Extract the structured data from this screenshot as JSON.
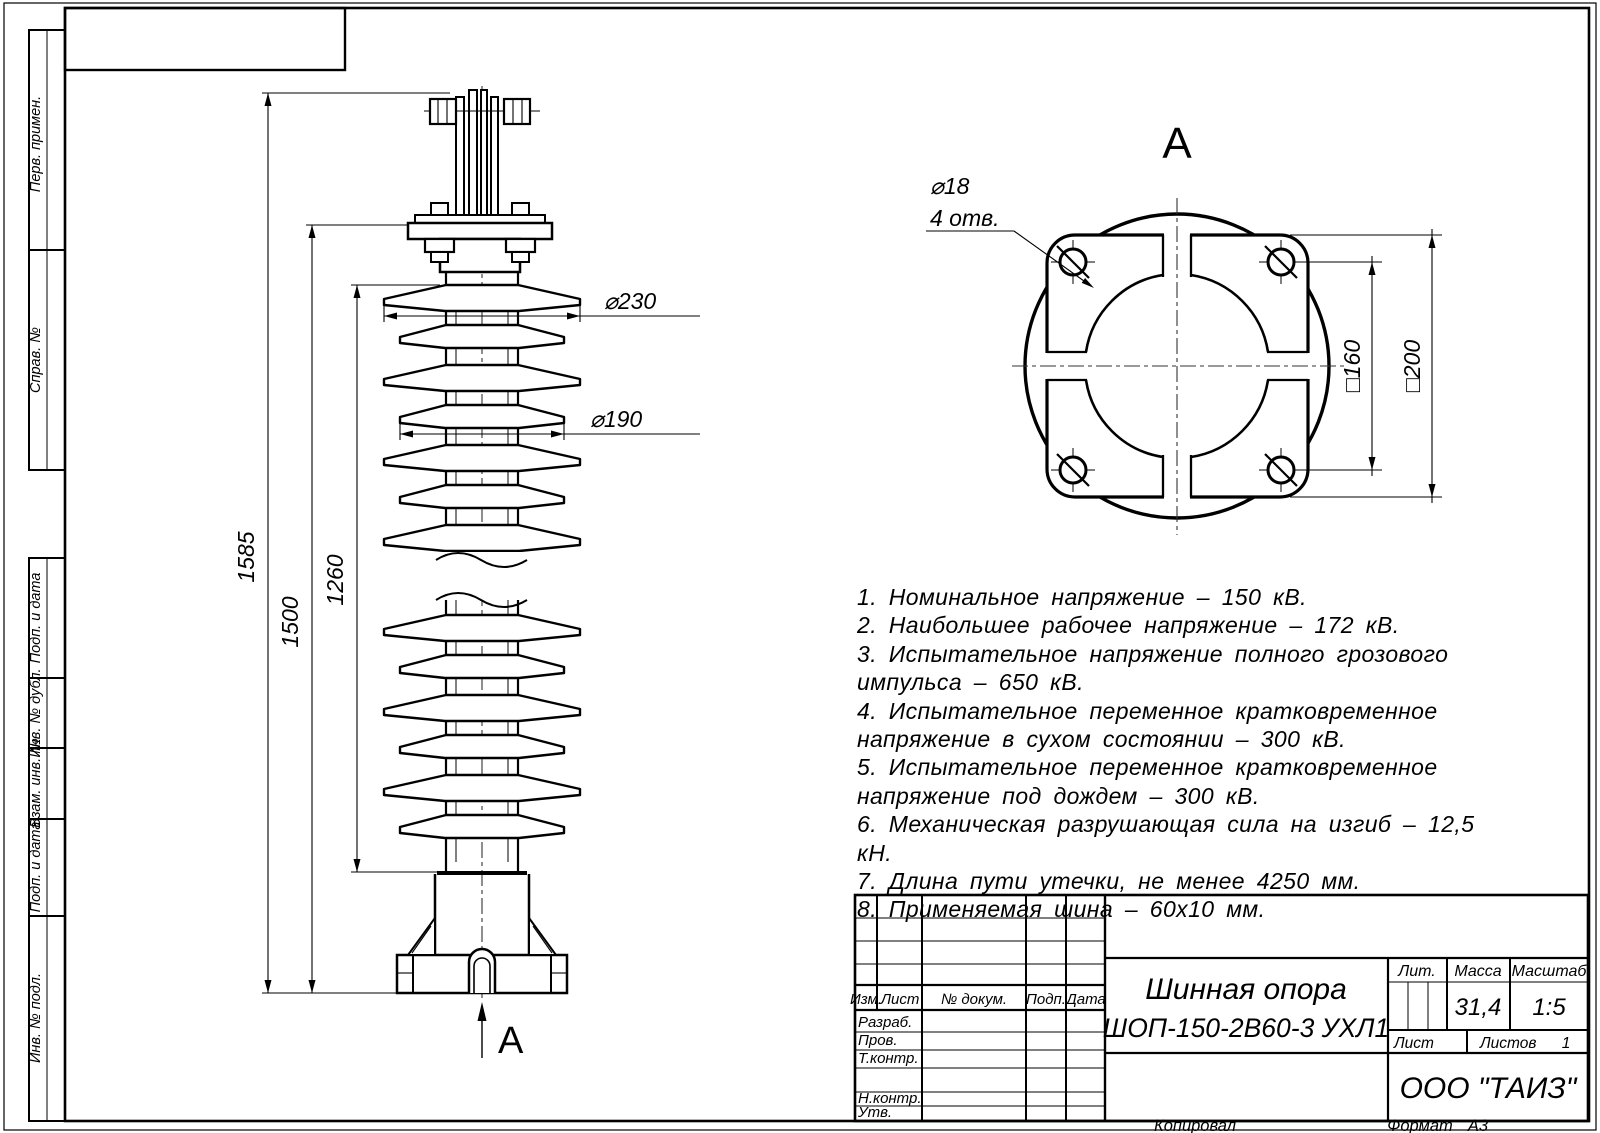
{
  "margin_labels": [
    "Перв. примен.",
    "Справ. №",
    "Подп. и дата",
    "Инв. № дубл.",
    "Взам. инв. №",
    "Подп. и дата",
    "Инв. № подл."
  ],
  "front_view": {
    "dim_overall": "1585",
    "dim_to_flange": "1500",
    "dim_body": "1260",
    "dim_shed_large": "⌀230",
    "dim_shed_small": "⌀190",
    "view_arrow_label": "А"
  },
  "view_a": {
    "title": "А",
    "hole_dia": "⌀18",
    "hole_count": "4 отв.",
    "dim_bolt_square": "□160",
    "dim_flange_square": "□200"
  },
  "tech_requirements": [
    "1. Номинальное напряжение – 150 кВ.",
    "2. Наибольшее рабочее напряжение – 172 кВ.",
    "3. Испытательное напряжение полного грозового импульса – 650 кВ.",
    "4. Испытательное переменное кратковременное напряжение в сухом состоянии – 300 кВ.",
    "5. Испытательное переменное кратковременное напряжение под дождем – 300 кВ.",
    "6. Механическая разрушающая сила на изгиб – 12,5 кН.",
    "7. Длина пути утечки, не менее 4250 мм.",
    "8. Применяемая шина – 60х10 мм."
  ],
  "title_block": {
    "rev_headers": [
      "Изм.",
      "Лист",
      "№ докум.",
      "Подп.",
      "Дата"
    ],
    "roles": [
      "Разраб.",
      "Пров.",
      "Т.контр.",
      "Н.контр.",
      "Утв."
    ],
    "doc_name_line1": "Шинная опора",
    "doc_name_line2": "ШОП-150-2В60-3 УХЛ1",
    "lit_label": "Лит.",
    "mass_label": "Масса",
    "scale_label": "Масштаб",
    "mass_value": "31,4",
    "scale_value": "1:5",
    "sheet_label": "Лист",
    "sheets_label": "Листов",
    "sheets_value": "1",
    "company": "ООО \"ТАИЗ\""
  },
  "footer": {
    "copied": "Копировал",
    "format_label": "Формат",
    "format_value": "А3"
  }
}
